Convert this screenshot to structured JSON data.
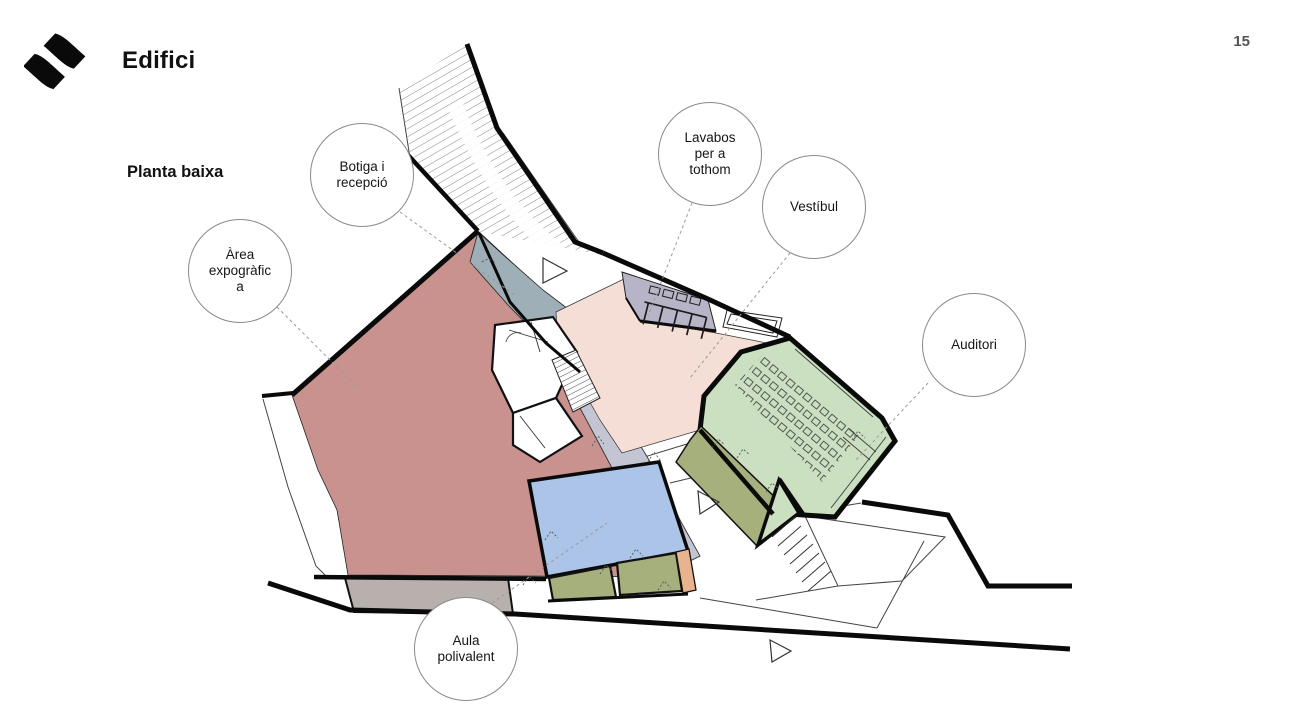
{
  "header": {
    "title": "Edifici",
    "logo": "wave-logo",
    "page_number": "15"
  },
  "plan": {
    "subtitle": "Planta baixa",
    "type": "ground-floor-plan",
    "labels": [
      {
        "id": "area-expografica",
        "lines": [
          "Àrea",
          "expogràfic",
          "a"
        ]
      },
      {
        "id": "botiga-recepcio",
        "lines": [
          "Botiga i",
          "recepció"
        ]
      },
      {
        "id": "lavabos",
        "lines": [
          "Lavabos",
          "per a",
          "tothom"
        ]
      },
      {
        "id": "vestibul",
        "lines": [
          "Vestíbul"
        ]
      },
      {
        "id": "auditori",
        "lines": [
          "Auditori"
        ]
      },
      {
        "id": "aula-polivalent",
        "lines": [
          "Aula",
          "polivalent"
        ]
      }
    ]
  },
  "colors": {
    "exhibition_pink": "#c9928e",
    "vestibule_pale": "#f5ded6",
    "shop_corridor_gray": "#9fafb7",
    "ramp_lavender": "#c4c5d2",
    "toilets_lilac": "#b6b4c6",
    "auditorium_green": "#cbe0c0",
    "stage_olive": "#a6b07d",
    "classroom_blue": "#abc4e8",
    "service_gray": "#b7b0ac",
    "accent_orange": "#e8b48e",
    "wall_black": "#0a0a0a",
    "leader_gray": "#999999"
  }
}
